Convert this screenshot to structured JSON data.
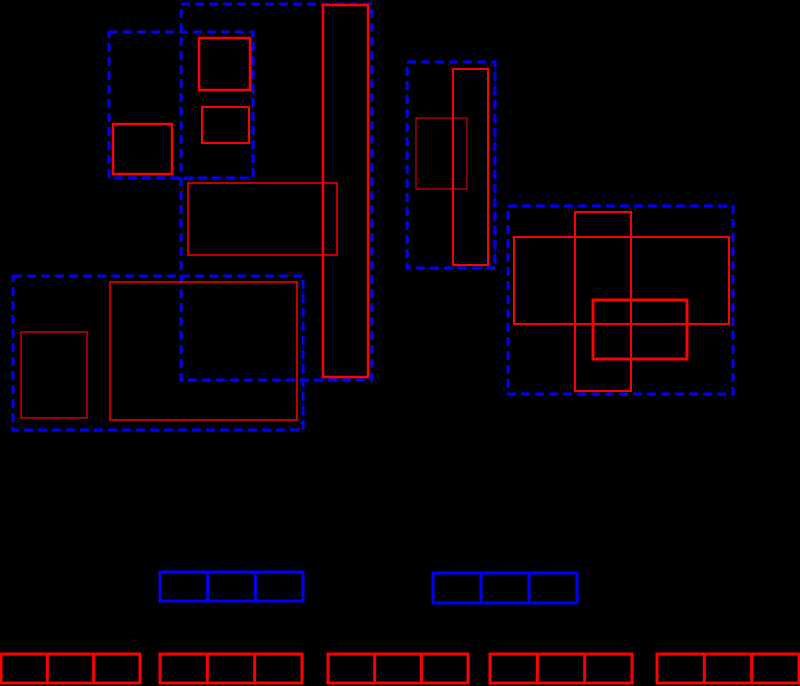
{
  "canvas": {
    "width": 800,
    "height": 686,
    "background": "#000000"
  },
  "palette": {
    "group_color": "#0000ff",
    "object_color": "#ff0000"
  },
  "diagram": {
    "dash_pattern": "9,5",
    "dashed_group_boxes": [
      {
        "name": "group-mbr-1",
        "x": 109,
        "y": 32,
        "w": 144,
        "h": 146,
        "sw": 3
      },
      {
        "name": "group-mbr-2",
        "x": 181,
        "y": 4,
        "w": 191,
        "h": 376,
        "sw": 3
      },
      {
        "name": "group-mbr-3",
        "x": 13,
        "y": 276,
        "w": 290,
        "h": 154,
        "sw": 3
      },
      {
        "name": "group-mbr-4",
        "x": 407,
        "y": 62,
        "w": 88,
        "h": 206,
        "sw": 3
      },
      {
        "name": "group-mbr-5",
        "x": 508,
        "y": 206,
        "w": 225,
        "h": 188,
        "sw": 3
      }
    ],
    "object_boxes": [
      {
        "name": "object-rect-1",
        "x": 199,
        "y": 38,
        "w": 51,
        "h": 52,
        "sw": 2.5
      },
      {
        "name": "object-rect-2",
        "x": 202,
        "y": 107,
        "w": 47,
        "h": 36,
        "sw": 2
      },
      {
        "name": "object-rect-3",
        "x": 113,
        "y": 124,
        "w": 59,
        "h": 50,
        "sw": 2.5
      },
      {
        "name": "object-rect-4",
        "x": 323,
        "y": 5,
        "w": 45,
        "h": 372,
        "sw": 2.5
      },
      {
        "name": "object-rect-5",
        "x": 188,
        "y": 183,
        "w": 149,
        "h": 72,
        "sw": 1.5
      },
      {
        "name": "object-rect-6",
        "x": 21,
        "y": 332,
        "w": 66,
        "h": 86,
        "sw": 1.2
      },
      {
        "name": "object-rect-7",
        "x": 110,
        "y": 282,
        "w": 187,
        "h": 138,
        "sw": 1.5
      },
      {
        "name": "object-rect-8",
        "x": 453,
        "y": 69,
        "w": 35,
        "h": 196,
        "sw": 2
      },
      {
        "name": "object-rect-9",
        "x": 416,
        "y": 118,
        "w": 51,
        "h": 71,
        "sw": 1
      },
      {
        "name": "object-rect-10",
        "x": 514,
        "y": 237,
        "w": 215,
        "h": 87,
        "sw": 2
      },
      {
        "name": "object-rect-11",
        "x": 575,
        "y": 212,
        "w": 56,
        "h": 179,
        "sw": 2
      },
      {
        "name": "object-rect-12",
        "x": 593,
        "y": 300,
        "w": 94,
        "h": 59,
        "sw": 3
      }
    ],
    "internal_node_boxes": [
      {
        "name": "internal-node-1",
        "x": 160,
        "y": 572,
        "w": 143,
        "h": 29,
        "cells": 3,
        "sw": 3
      },
      {
        "name": "internal-node-2",
        "x": 433,
        "y": 573,
        "w": 144,
        "h": 30,
        "cells": 3,
        "sw": 3
      }
    ],
    "leaf_node_boxes": [
      {
        "name": "leaf-node-1",
        "x": 1,
        "y": 654,
        "w": 139,
        "h": 29,
        "cells": 3,
        "sw": 3
      },
      {
        "name": "leaf-node-2",
        "x": 160,
        "y": 654,
        "w": 142,
        "h": 29,
        "cells": 3,
        "sw": 3
      },
      {
        "name": "leaf-node-3",
        "x": 328,
        "y": 654,
        "w": 140,
        "h": 29,
        "cells": 3,
        "sw": 3
      },
      {
        "name": "leaf-node-4",
        "x": 490,
        "y": 654,
        "w": 142,
        "h": 29,
        "cells": 3,
        "sw": 3
      },
      {
        "name": "leaf-node-5",
        "x": 657,
        "y": 654,
        "w": 142,
        "h": 29,
        "cells": 3,
        "sw": 3
      }
    ]
  }
}
